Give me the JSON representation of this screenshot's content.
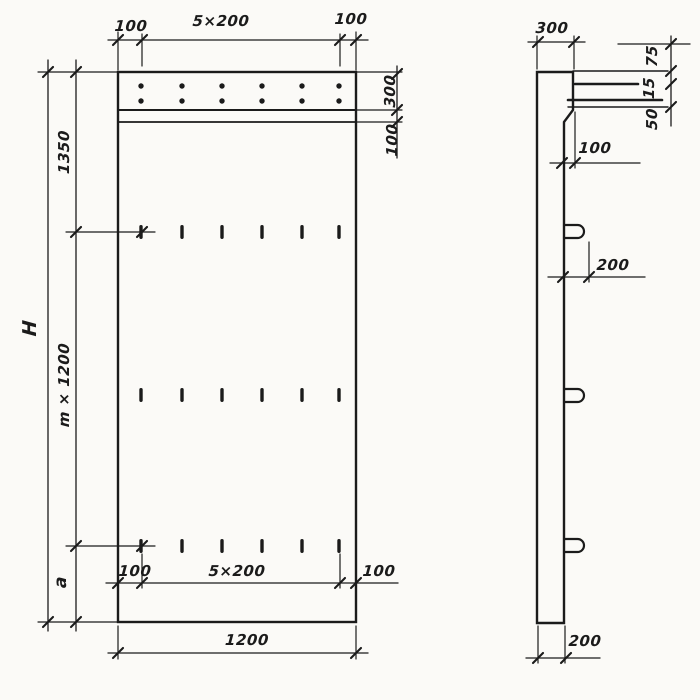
{
  "colors": {
    "ink": "#1b1b1b",
    "paper": "#fbfaf7"
  },
  "front_view": {
    "top_dim_left": "100",
    "top_dim_span": "5×200",
    "top_dim_right": "100",
    "header_height": "300",
    "strip_height": "100",
    "zone_top": "1350",
    "zone_middle": "m × 1200",
    "zone_bottom": "a",
    "total_height": "H",
    "bottom_dim_left": "100",
    "bottom_dim_span": "5×200",
    "bottom_dim_right": "100",
    "overall_width": "1200"
  },
  "side_view": {
    "top_thickness": "300",
    "edge_dim_top": "75",
    "edge_dim_mid": "15",
    "edge_dim_bot": "50",
    "ledge_offset": "100",
    "loop_projection": "200",
    "bottom_thickness": "200"
  }
}
